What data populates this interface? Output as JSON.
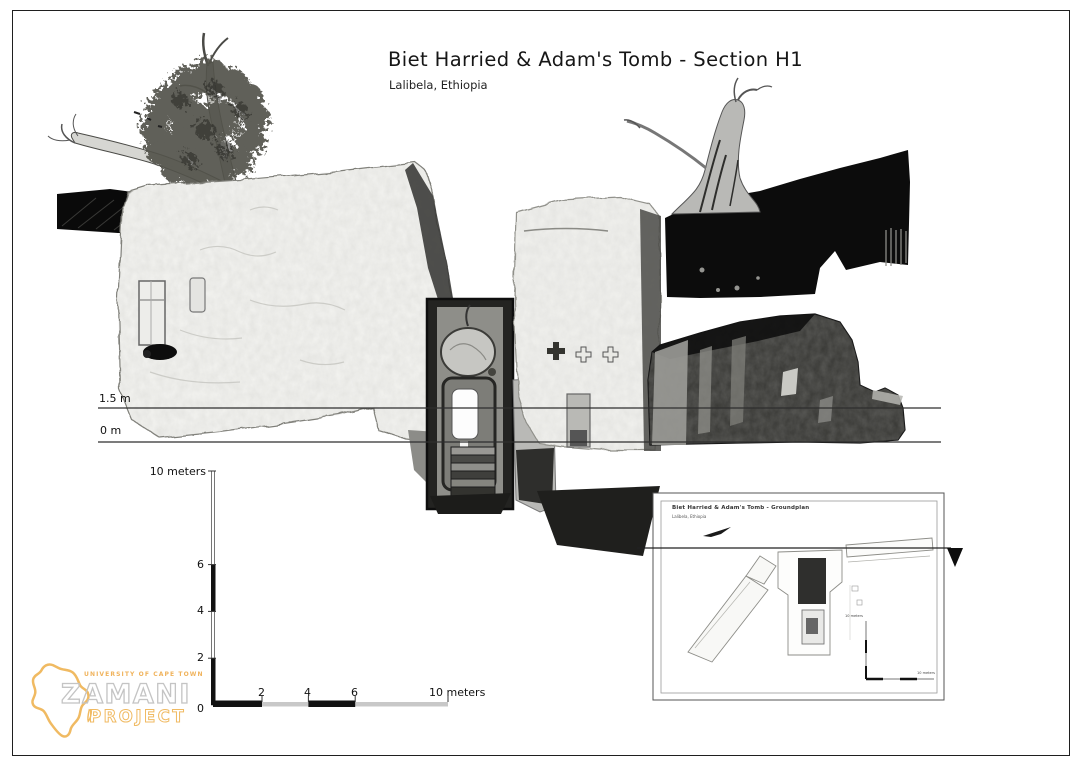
{
  "page": {
    "title": "Biet Harried & Adam's Tomb - Section H1",
    "subtitle": "Lalibela, Ethiopia"
  },
  "reference_lines": {
    "upper_label": "1.5 m",
    "lower_label": "0 m"
  },
  "vertical_scale": {
    "top_label": "10 meters",
    "ticks": [
      "6",
      "4",
      "2"
    ],
    "origin_label": "0"
  },
  "horizontal_scale": {
    "ticks": [
      "2",
      "4",
      "6"
    ],
    "end_label": "10 meters"
  },
  "inset": {
    "title": "Biet Harried & Adam's Tomb - Groundplan",
    "subtitle": "Lalibela, Ethiopia",
    "vscale_label": "10 meters",
    "hscale_label": "10 meters"
  },
  "logo": {
    "institution": "UNIVERSITY OF CAPE TOWN",
    "name": "ZAMANI",
    "subname": "PROJECT"
  },
  "colors": {
    "logo_orange": "#f0ba62",
    "logo_gray": "#c4c4c4",
    "reference_line": "#2e2e2e",
    "scale_black": "#111111",
    "scale_gray": "#c8c8c8"
  }
}
